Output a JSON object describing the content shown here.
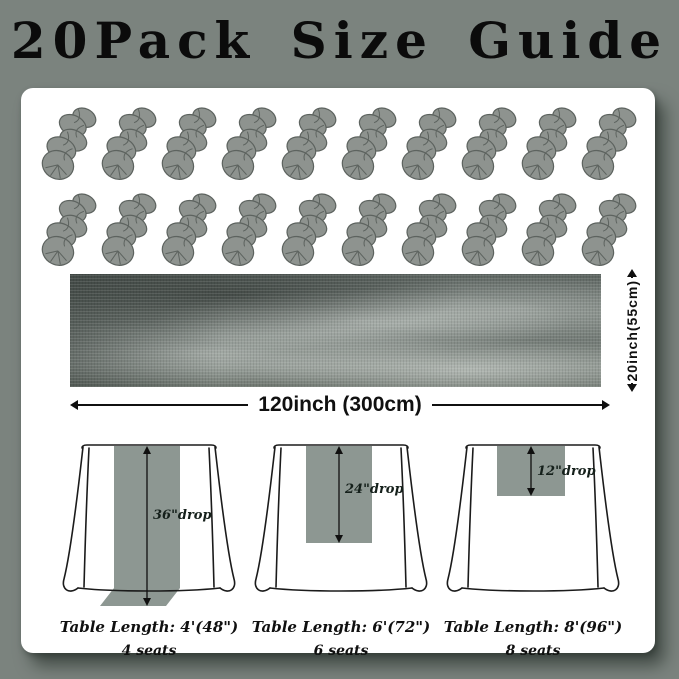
{
  "title": "20Pack Size Guide",
  "skeins": {
    "count": 20,
    "rows": 2,
    "per_row": 10,
    "color": "#8e938f"
  },
  "runner": {
    "length_label": "120inch (300cm)",
    "width_label": "20inch(55cm)"
  },
  "tables": [
    {
      "drop_label": "36\"drop",
      "length_label": "Table Length: 4'(48\")",
      "seats_label": "4 seats"
    },
    {
      "drop_label": "24\"drop",
      "length_label": "Table Length: 6'(72\")",
      "seats_label": "6 seats"
    },
    {
      "drop_label": "12\"drop",
      "length_label": "Table Length: 8'(96\")",
      "seats_label": "8 seats"
    }
  ],
  "colors": {
    "background": "#7b837e",
    "panel": "#ffffff",
    "runner_fill": "#8d9792",
    "skein_fill": "#8e938f",
    "text": "#101010"
  }
}
